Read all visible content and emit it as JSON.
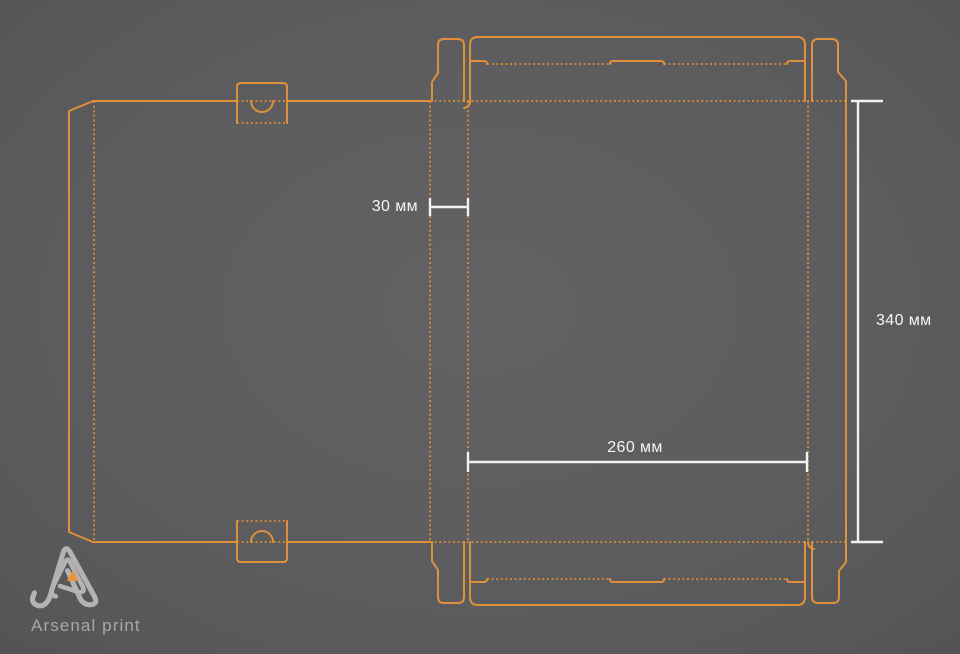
{
  "title": "Box dieline drawing with dimensions",
  "colors": {
    "background_center": "#616163",
    "background_edge": "#515153",
    "dieline_solid": "#e0903a",
    "dieline_dotted": "#d68c33",
    "dimension_line": "#f1f1f1",
    "dimension_text": "#f5f5f5",
    "logo_gray": "#b3b3b3",
    "logo_orange": "#e8923a",
    "logo_text": "#a8a8a8"
  },
  "dimensions": {
    "spine": {
      "label": "30 мм",
      "value_mm": 30,
      "measures": "spine width"
    },
    "height": {
      "label": "340 мм",
      "value_mm": 340,
      "measures": "panel height"
    },
    "width": {
      "label": "260 мм",
      "value_mm": 260,
      "measures": "panel width"
    }
  },
  "logo": {
    "text": "Arsenal print"
  }
}
